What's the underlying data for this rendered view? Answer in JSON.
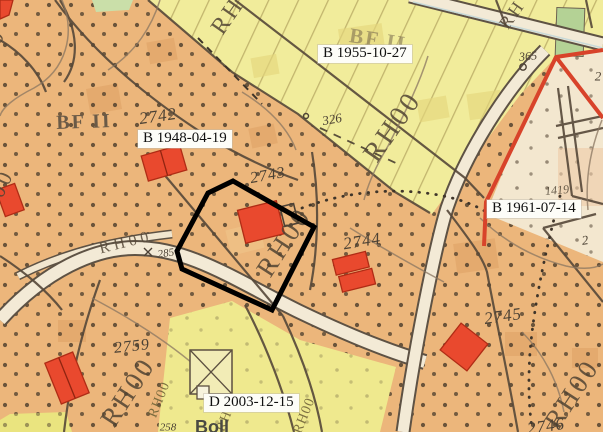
{
  "map": {
    "type": "cadastral-zoning-map",
    "plan_labels": {
      "b1955": "B 1955-10-27",
      "b1948": "B 1948-04-19",
      "b1961": "B 1961-07-14",
      "d2003": "D 2003-12-15"
    },
    "zone_codes": {
      "bf2": "BF II",
      "rh00": "RH00",
      "rh": "RH"
    },
    "parcel_numbers": {
      "n2742": "2742",
      "n2743": "2743",
      "n2744": "2744",
      "n2745": "2745",
      "n2746": "2746",
      "n2759": "2759"
    },
    "survey_marks": {
      "m326": "326",
      "m365": "365",
      "m285": "285",
      "m258": "258",
      "m1419": "1419",
      "m2a": "2",
      "m2b": "2"
    },
    "bottom_label": "Boll",
    "colors": {
      "highlight_outline": "#000000",
      "plan_boundary_red": "#d8432a",
      "building_red": "#e9492e",
      "zone_orange": "#ecb67b",
      "zone_yellow": "#f1ec9b",
      "zone_cream": "#f3e7cf",
      "zone_green": "#b4d295",
      "zone_yellow_d": "#efe98e"
    }
  }
}
